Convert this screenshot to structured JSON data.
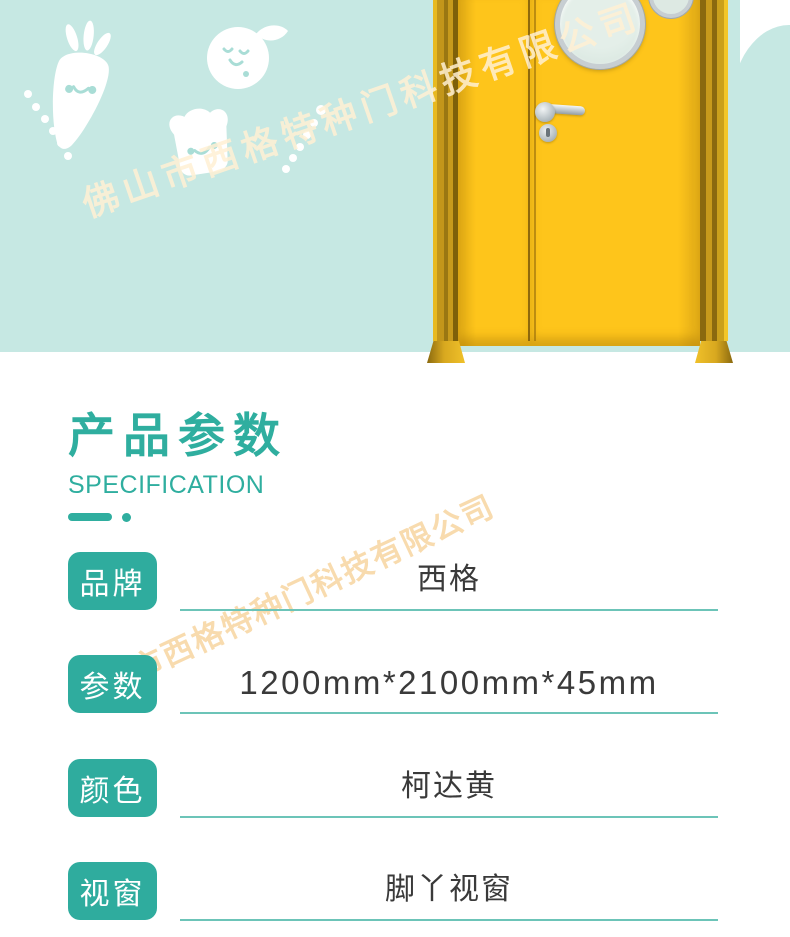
{
  "watermark": {
    "text": "佛山市西格特种门科技有限公司"
  },
  "hero": {
    "background_color": "#c6e8e3",
    "door_color": "#fec51b",
    "icons": [
      "carrot-icon",
      "fruit-icon",
      "bread-icon",
      "porthole-window",
      "door-handle"
    ]
  },
  "section": {
    "title": "产品参数",
    "subtitle": "SPECIFICATION",
    "accent_color": "#2fae9f"
  },
  "table": {
    "underline_color": "#6cc4b8",
    "rows": [
      {
        "label": "品牌",
        "value": "西格"
      },
      {
        "label": "参数",
        "value": "1200mm*2100mm*45mm"
      },
      {
        "label": "颜色",
        "value": "柯达黄"
      },
      {
        "label": "视窗",
        "value": "脚丫视窗"
      }
    ]
  }
}
